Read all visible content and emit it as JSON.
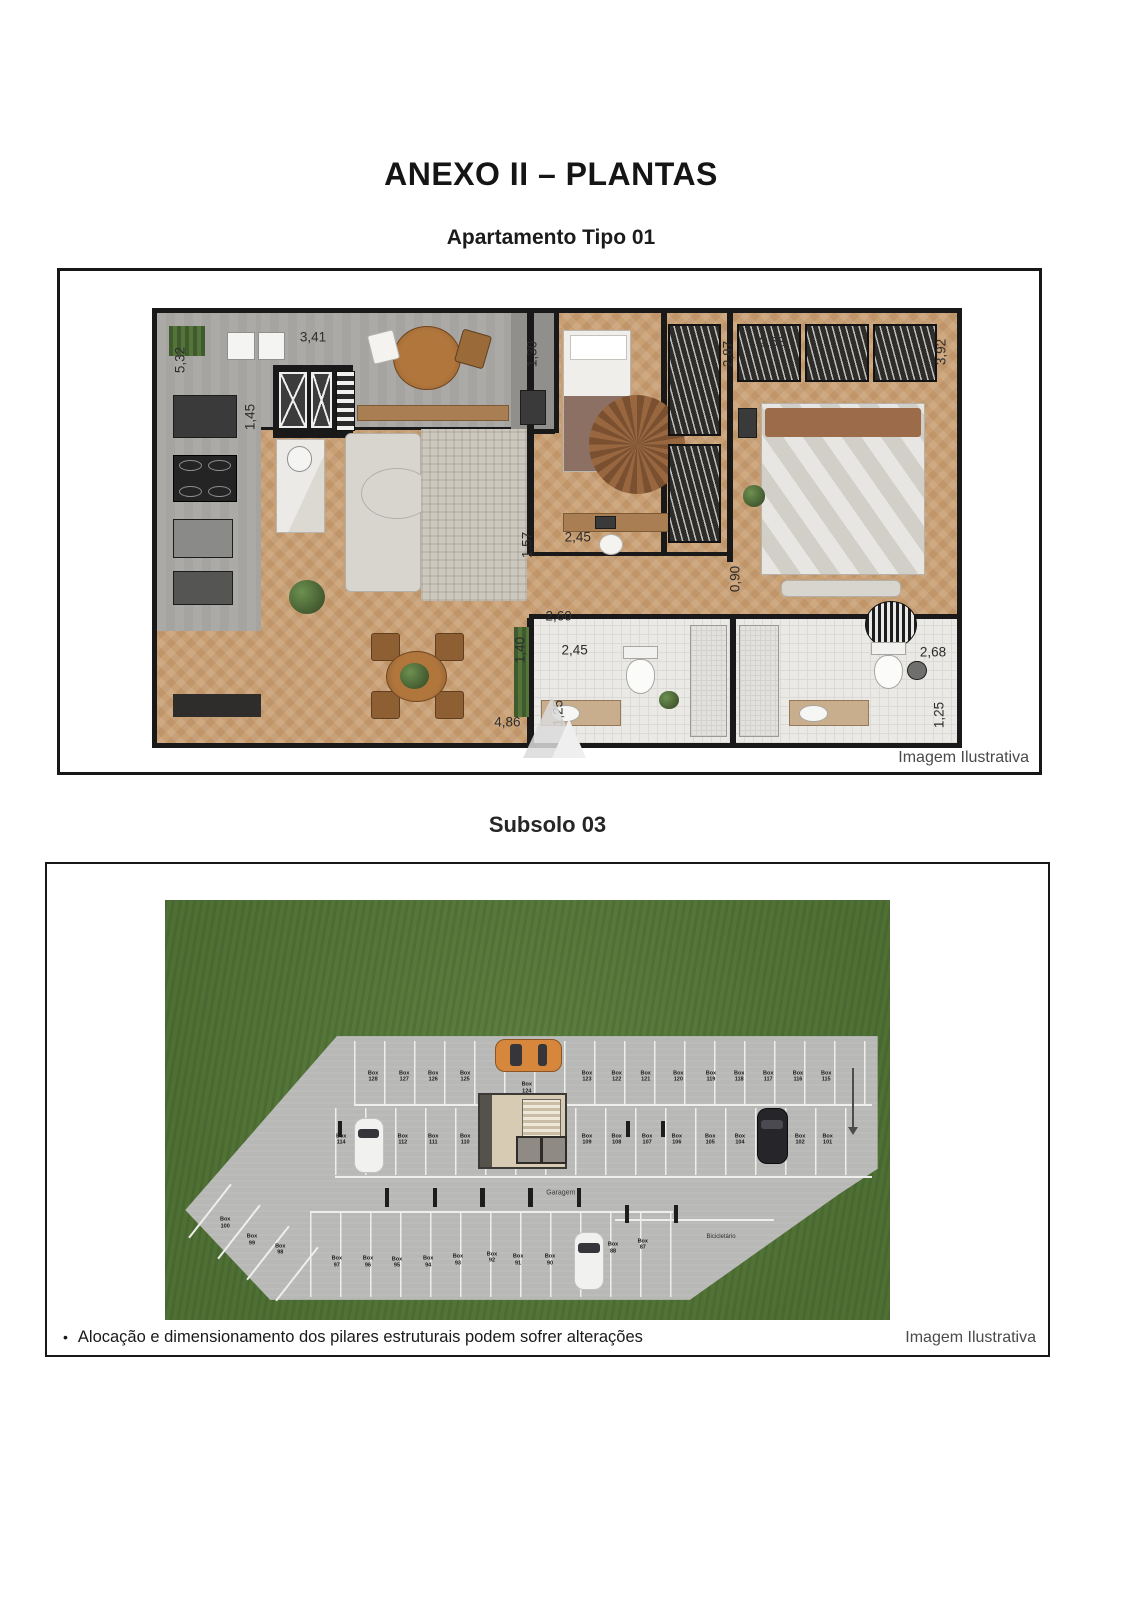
{
  "page": {
    "title": "ANEXO II – PLANTAS",
    "subtitle_apartment": "Apartamento Tipo 01",
    "subtitle_basement": "Subsolo 03",
    "caption_apartment": "Imagem Ilustrativa",
    "caption_basement": "Imagem Ilustrativa",
    "footnote_bullet": "•",
    "footnote": "Alocação e dimensionamento dos pilares estruturais podem sofrer alterações"
  },
  "colors": {
    "wall": "#191919",
    "wood_floor": "#c79e72",
    "concrete_floor": "#a5a4a0",
    "grass": "#57793a",
    "deck": "#b8b8b6",
    "accent_car_orange": "#d6873c"
  },
  "apartment": {
    "dims": [
      {
        "t": "5,32",
        "v": true,
        "x": 2.9,
        "y": 11
      },
      {
        "t": "3,41",
        "v": false,
        "x": 19.5,
        "y": 5.5
      },
      {
        "t": "1,45",
        "v": true,
        "x": 11.6,
        "y": 24.3
      },
      {
        "t": "1,30",
        "v": true,
        "x": 46.9,
        "y": 9.5
      },
      {
        "t": "2,87",
        "v": true,
        "x": 71.4,
        "y": 9.5
      },
      {
        "t": "2,68",
        "v": false,
        "x": 76.9,
        "y": 6.8
      },
      {
        "t": "3,92",
        "v": true,
        "x": 98.0,
        "y": 9.1
      },
      {
        "t": "1,57",
        "v": true,
        "x": 46.3,
        "y": 53.9
      },
      {
        "t": "2,45",
        "v": false,
        "x": 52.6,
        "y": 52.0
      },
      {
        "t": "0,90",
        "v": true,
        "x": 72.2,
        "y": 61.8
      },
      {
        "t": "2,60",
        "v": false,
        "x": 50.2,
        "y": 70.5
      },
      {
        "t": "1,40",
        "v": true,
        "x": 45.4,
        "y": 78.4
      },
      {
        "t": "2,45",
        "v": false,
        "x": 52.2,
        "y": 78.4
      },
      {
        "t": "4,86",
        "v": false,
        "x": 43.8,
        "y": 95.0
      },
      {
        "t": "1,25",
        "v": true,
        "x": 50.1,
        "y": 93.0
      },
      {
        "t": "2,68",
        "v": false,
        "x": 97.0,
        "y": 78.9
      },
      {
        "t": "1,25",
        "v": true,
        "x": 97.8,
        "y": 93.6
      }
    ]
  },
  "garage": {
    "garagem_label": "Garagem",
    "bicicletario_label": "Bicicletário",
    "stalls": [
      {
        "t": "Box\n128",
        "x": 28.7,
        "y": 42.1
      },
      {
        "t": "Box\n127",
        "x": 33.0,
        "y": 42.1
      },
      {
        "t": "Box\n126",
        "x": 37.0,
        "y": 42.1
      },
      {
        "t": "Box\n125",
        "x": 41.4,
        "y": 42.1
      },
      {
        "t": "Box\n124",
        "x": 49.9,
        "y": 44.8
      },
      {
        "t": "Box\n123",
        "x": 58.2,
        "y": 42.1
      },
      {
        "t": "Box\n122",
        "x": 62.3,
        "y": 42.1
      },
      {
        "t": "Box\n121",
        "x": 66.3,
        "y": 42.1
      },
      {
        "t": "Box\n120",
        "x": 70.8,
        "y": 42.1
      },
      {
        "t": "Box\n119",
        "x": 75.3,
        "y": 42.1
      },
      {
        "t": "Box\n118",
        "x": 79.2,
        "y": 42.1
      },
      {
        "t": "Box\n117",
        "x": 83.2,
        "y": 42.1
      },
      {
        "t": "Box\n116",
        "x": 87.3,
        "y": 42.1
      },
      {
        "t": "Box\n115",
        "x": 91.2,
        "y": 42.1
      },
      {
        "t": "Box\n114",
        "x": 24.3,
        "y": 57.1
      },
      {
        "t": "Box\n112",
        "x": 32.8,
        "y": 57.1
      },
      {
        "t": "Box\n111",
        "x": 37.0,
        "y": 57.1
      },
      {
        "t": "Box\n110",
        "x": 41.4,
        "y": 57.1
      },
      {
        "t": "Box\n109",
        "x": 58.2,
        "y": 57.1
      },
      {
        "t": "Box\n108",
        "x": 62.3,
        "y": 57.1
      },
      {
        "t": "Box\n107",
        "x": 66.5,
        "y": 57.1
      },
      {
        "t": "Box\n106",
        "x": 70.6,
        "y": 57.1
      },
      {
        "t": "Box\n105",
        "x": 75.2,
        "y": 57.1
      },
      {
        "t": "Box\n104",
        "x": 79.3,
        "y": 57.1
      },
      {
        "t": "Box\n102",
        "x": 87.6,
        "y": 57.1
      },
      {
        "t": "Box\n101",
        "x": 91.4,
        "y": 57.1
      },
      {
        "t": "Box\n100",
        "x": 8.3,
        "y": 76.9
      },
      {
        "t": "Box\n99",
        "x": 12.0,
        "y": 81.0
      },
      {
        "t": "Box\n98",
        "x": 15.9,
        "y": 83.3
      },
      {
        "t": "Box\n97",
        "x": 23.7,
        "y": 86.2
      },
      {
        "t": "Box\n96",
        "x": 28.0,
        "y": 86.2
      },
      {
        "t": "Box\n95",
        "x": 32.0,
        "y": 86.4
      },
      {
        "t": "Box\n94",
        "x": 36.3,
        "y": 86.2
      },
      {
        "t": "Box\n93",
        "x": 40.4,
        "y": 85.7
      },
      {
        "t": "Box\n92",
        "x": 45.1,
        "y": 85.2
      },
      {
        "t": "Box\n91",
        "x": 48.7,
        "y": 85.7
      },
      {
        "t": "Box\n90",
        "x": 53.1,
        "y": 85.7
      },
      {
        "t": "Box\n88",
        "x": 61.8,
        "y": 82.9
      },
      {
        "t": "Box\n87",
        "x": 65.9,
        "y": 82.1
      }
    ]
  }
}
